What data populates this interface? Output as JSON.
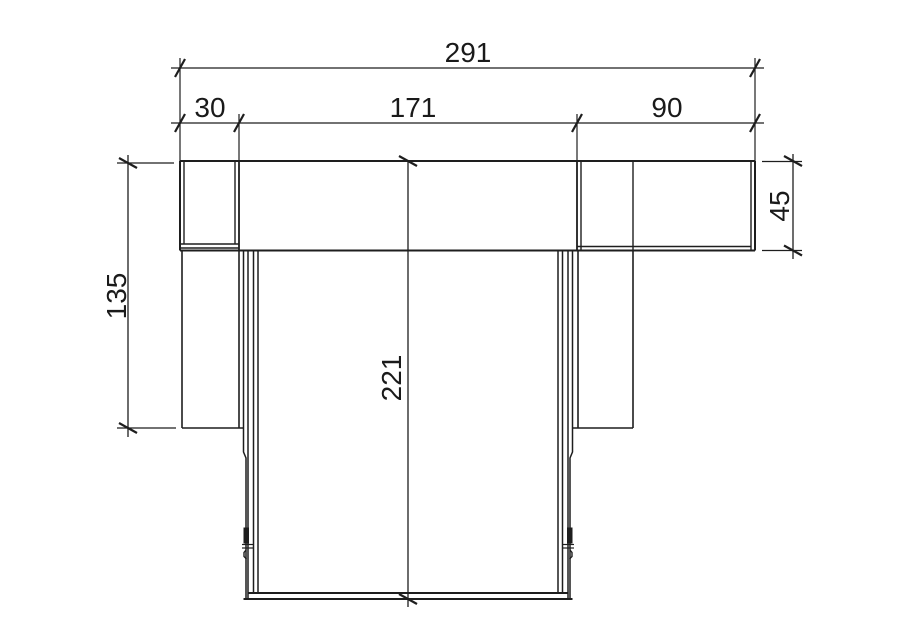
{
  "canvas": {
    "background": "#ffffff",
    "line_color": "#1e1e1e",
    "text_color": "#1a1a1a"
  },
  "dimensions": {
    "total_width": "291",
    "segment_left": "30",
    "segment_middle": "171",
    "segment_right": "90",
    "flange_height": "45",
    "side_depth": "135",
    "overall_depth": "221"
  }
}
